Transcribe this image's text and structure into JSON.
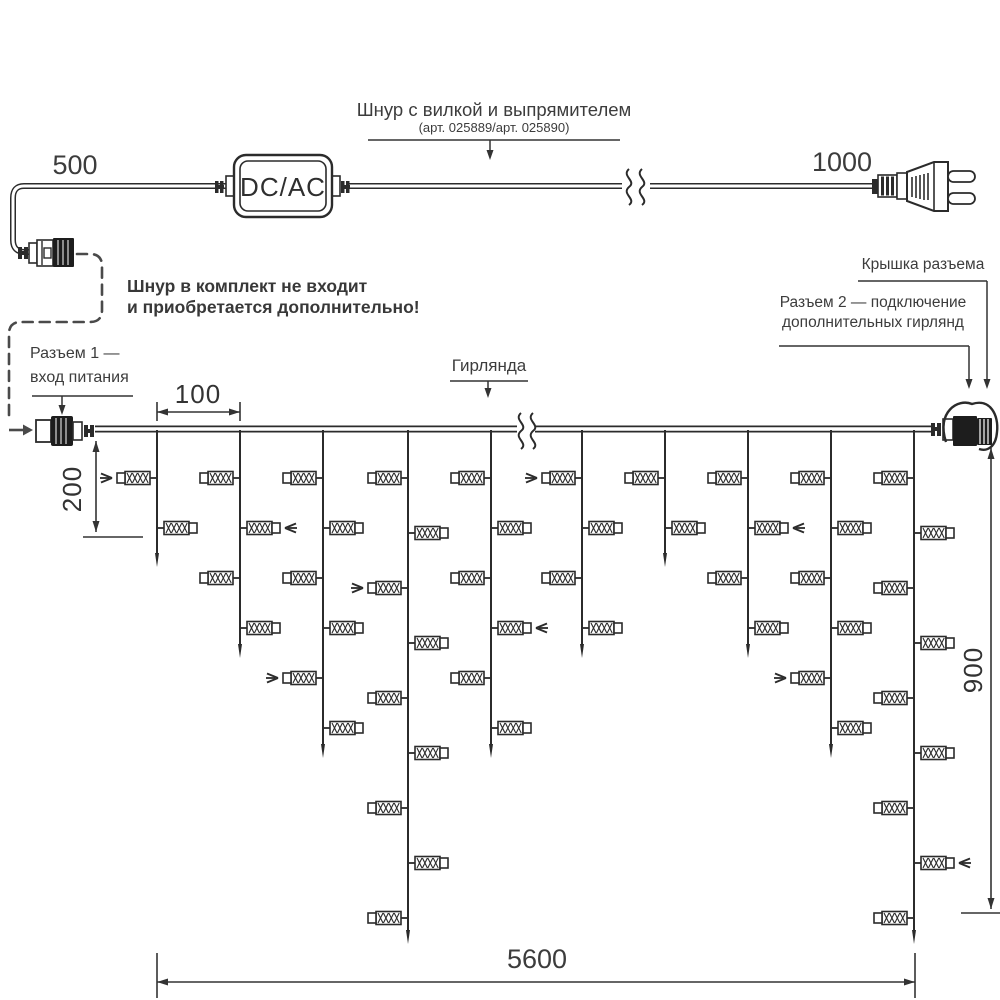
{
  "diagram": {
    "cord_label": "Шнур с вилкой и выпрямителем",
    "cord_article": "(арт. 025889/арт. 025890)",
    "converter_label": "DC/AC",
    "warning_line1": "Шнур в комплект не входит",
    "warning_line2": "и приобретается дополнительно!",
    "connector1_line1": "Разъем 1 —",
    "connector1_line2": "вход питания",
    "garland_label": "Гирлянда",
    "cap_label": "Крышка разъема",
    "connector2_line1": "Разъем 2 — подключение",
    "connector2_line2": "дополнительных гирлянд"
  },
  "dimensions": {
    "cord_to_converter": "500",
    "cord_to_plug": "1000",
    "drop_spacing": "100",
    "short_drop": "200",
    "long_drop": "900",
    "garland_length": "5600"
  },
  "garland": {
    "line_y": 429,
    "x_start": 95,
    "x_end": 931,
    "break_x": 526,
    "rows_standard": [
      478,
      528,
      578,
      628,
      678,
      728
    ],
    "rows_long": [
      478,
      533,
      588,
      643,
      698,
      753,
      808,
      863,
      918
    ],
    "drops": [
      {
        "x": 157,
        "lights": 2,
        "tip": 567,
        "arrows": [
          0
        ]
      },
      {
        "x": 240,
        "lights": 4,
        "tip": 658,
        "arrows": [
          1
        ]
      },
      {
        "x": 323,
        "lights": 6,
        "tip": 758,
        "arrows": [
          4
        ]
      },
      {
        "x": 408,
        "lights": 9,
        "tip": 944,
        "arrows": [
          2
        ]
      },
      {
        "x": 491,
        "lights": 6,
        "tip": 758,
        "arrows": [
          3
        ]
      },
      {
        "x": 582,
        "lights": 4,
        "tip": 658,
        "arrows": [
          0
        ]
      },
      {
        "x": 665,
        "lights": 2,
        "tip": 567,
        "arrows": []
      },
      {
        "x": 748,
        "lights": 4,
        "tip": 658,
        "arrows": [
          1
        ]
      },
      {
        "x": 831,
        "lights": 6,
        "tip": 758,
        "arrows": [
          4
        ]
      },
      {
        "x": 914,
        "lights": 9,
        "tip": 944,
        "arrows": [
          7
        ]
      }
    ]
  },
  "colors": {
    "line": "#2b2b2b",
    "text": "#3c3c3c",
    "dashed": "#4a4a4a",
    "background": "#ffffff"
  }
}
